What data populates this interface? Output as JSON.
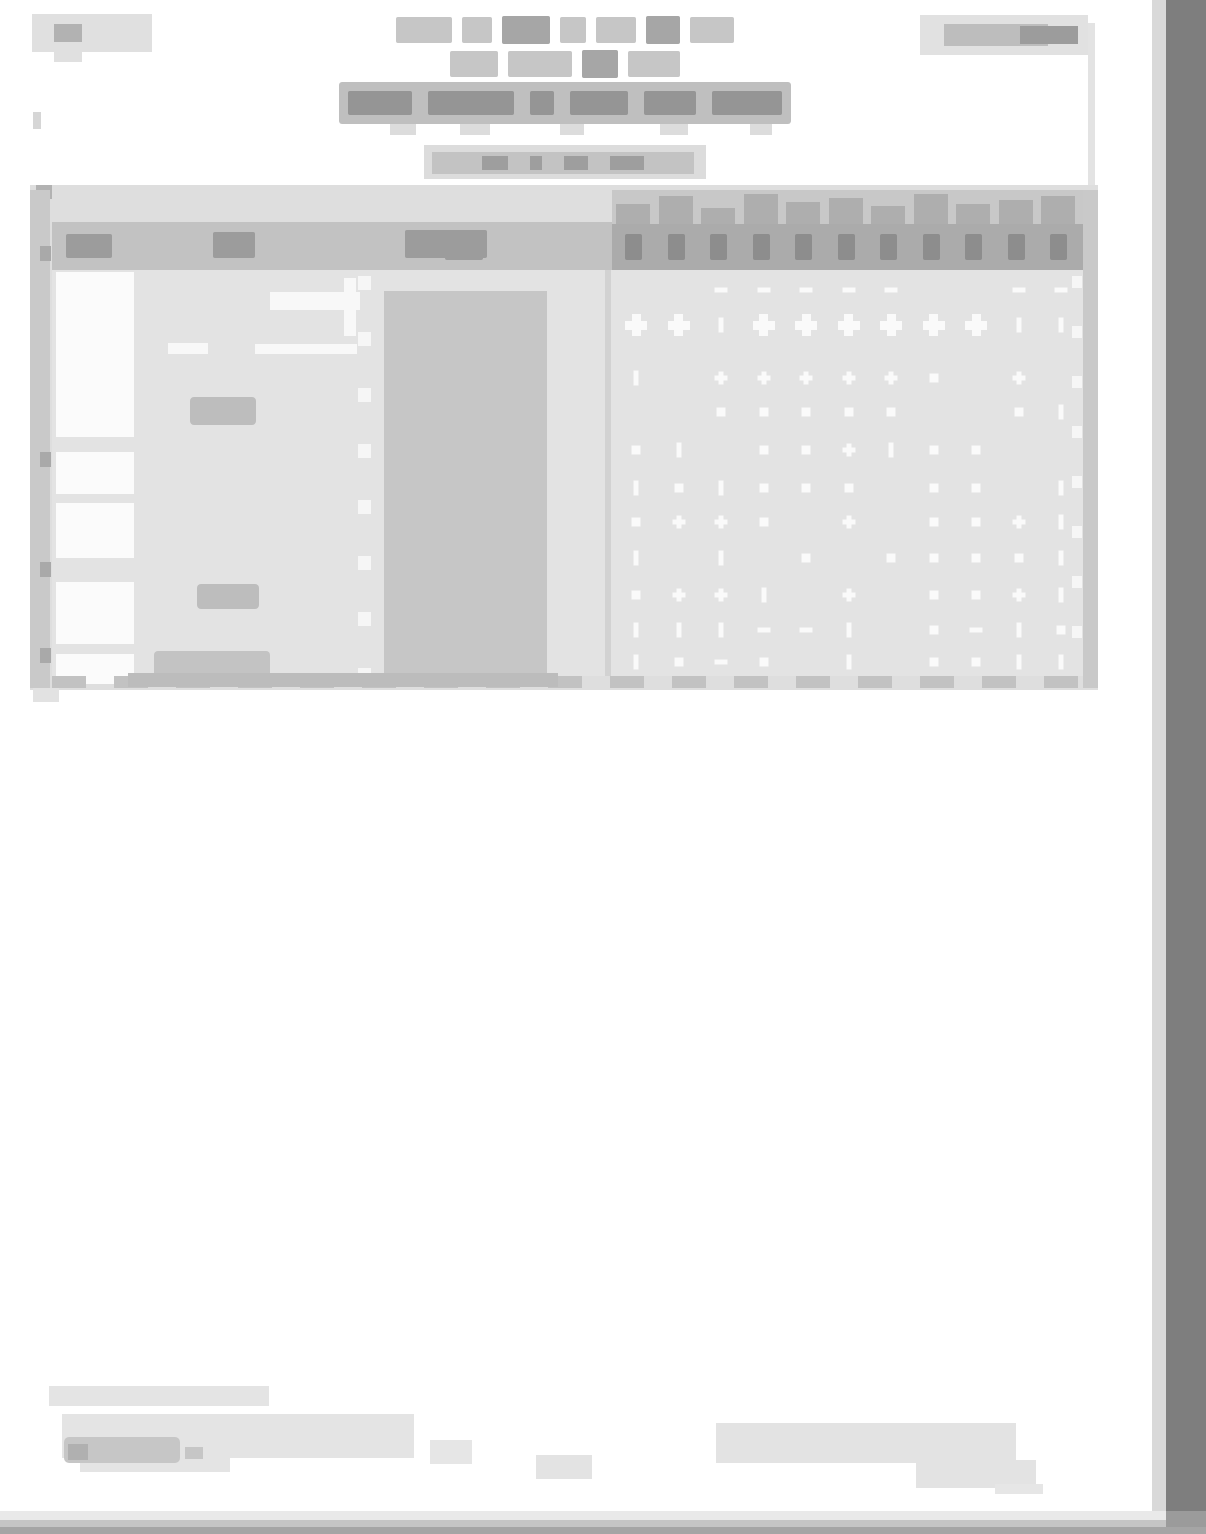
{
  "document": {
    "legibility": "illegible-low-resolution-scan",
    "visible_text": ""
  },
  "colors": {
    "page_background": "#ffffff",
    "scan_edge_right": "#7e7e7e",
    "scan_bottom_bands": [
      "#e9e9e9",
      "#c5c5c5",
      "#a5a5a5"
    ],
    "table_frame": "#dedede",
    "table_body": "#e3e3e3",
    "header_band_left": "#c2c2c2",
    "header_band_right": "#ababab",
    "filled_column": "#c6c6c6",
    "grid_marks": "#fafafa",
    "title_band": "#bfbfbf",
    "ink_blob": "#9c9c9c"
  },
  "title": {
    "row1_words": [
      {
        "w": 56,
        "s": "m"
      },
      {
        "w": 30,
        "s": "m"
      },
      {
        "w": 48,
        "s": "d"
      },
      {
        "w": 26,
        "s": "m"
      },
      {
        "w": 40,
        "s": "m"
      },
      {
        "w": 34,
        "s": "d"
      },
      {
        "w": 44,
        "s": "m"
      }
    ],
    "row2_words": [
      {
        "w": 48,
        "s": "m"
      },
      {
        "w": 64,
        "s": "m"
      },
      {
        "w": 36,
        "s": "d"
      },
      {
        "w": 52,
        "s": "m"
      }
    ],
    "row3_band_words": [
      64,
      86,
      24,
      58,
      52,
      70
    ],
    "descenders": [
      {
        "x": 60,
        "w": 26
      },
      {
        "x": 130,
        "w": 30
      },
      {
        "x": 230,
        "w": 24
      },
      {
        "x": 330,
        "w": 28
      },
      {
        "x": 420,
        "w": 22
      }
    ],
    "subtitle_words": [
      26,
      12,
      24,
      34
    ]
  },
  "table": {
    "header": {
      "left_labels": [
        {
          "x": 36,
          "y": 49,
          "w": 46,
          "h": 24
        },
        {
          "x": 183,
          "y": 47,
          "w": 42,
          "h": 26
        },
        {
          "x": 375,
          "y": 45,
          "w": 82,
          "h": 28
        },
        {
          "x": 415,
          "y": 67,
          "w": 38,
          "h": 8
        }
      ],
      "right_columns": 11,
      "jag_heights": [
        20,
        28,
        16,
        30,
        22,
        26,
        18,
        30,
        20,
        24,
        28
      ]
    },
    "grid": {
      "cols": 11,
      "first_col_x": 21,
      "col_spacing": 42.5,
      "mark_rows": [
        {
          "y": 20,
          "pattern": "  -----  --"
        },
        {
          "y": 55,
          "pattern": "BB|BBBBBB||"
        },
        {
          "y": 108,
          "pattern": "| +++++s + "
        },
        {
          "y": 142,
          "pattern": "  sssss  s|"
        },
        {
          "y": 180,
          "pattern": "s| ss+|ss  "
        },
        {
          "y": 218,
          "pattern": "|s|sss ss |"
        },
        {
          "y": 252,
          "pattern": "s++s + ss+|"
        },
        {
          "y": 288,
          "pattern": "| | s ssss|"
        },
        {
          "y": 325,
          "pattern": "s++| + ss+|"
        },
        {
          "y": 360,
          "pattern": "|||--| s-|s"
        },
        {
          "y": 392,
          "pattern": "|s-s | ss||"
        }
      ]
    },
    "number_column_cells": [
      {
        "y": 87,
        "h": 165
      },
      {
        "y": 267,
        "h": 42
      },
      {
        "y": 318,
        "h": 55
      },
      {
        "y": 397,
        "h": 62
      },
      {
        "y": 469,
        "h": 30
      }
    ],
    "left_border_ticks": [
      61,
      267,
      377,
      463
    ]
  }
}
